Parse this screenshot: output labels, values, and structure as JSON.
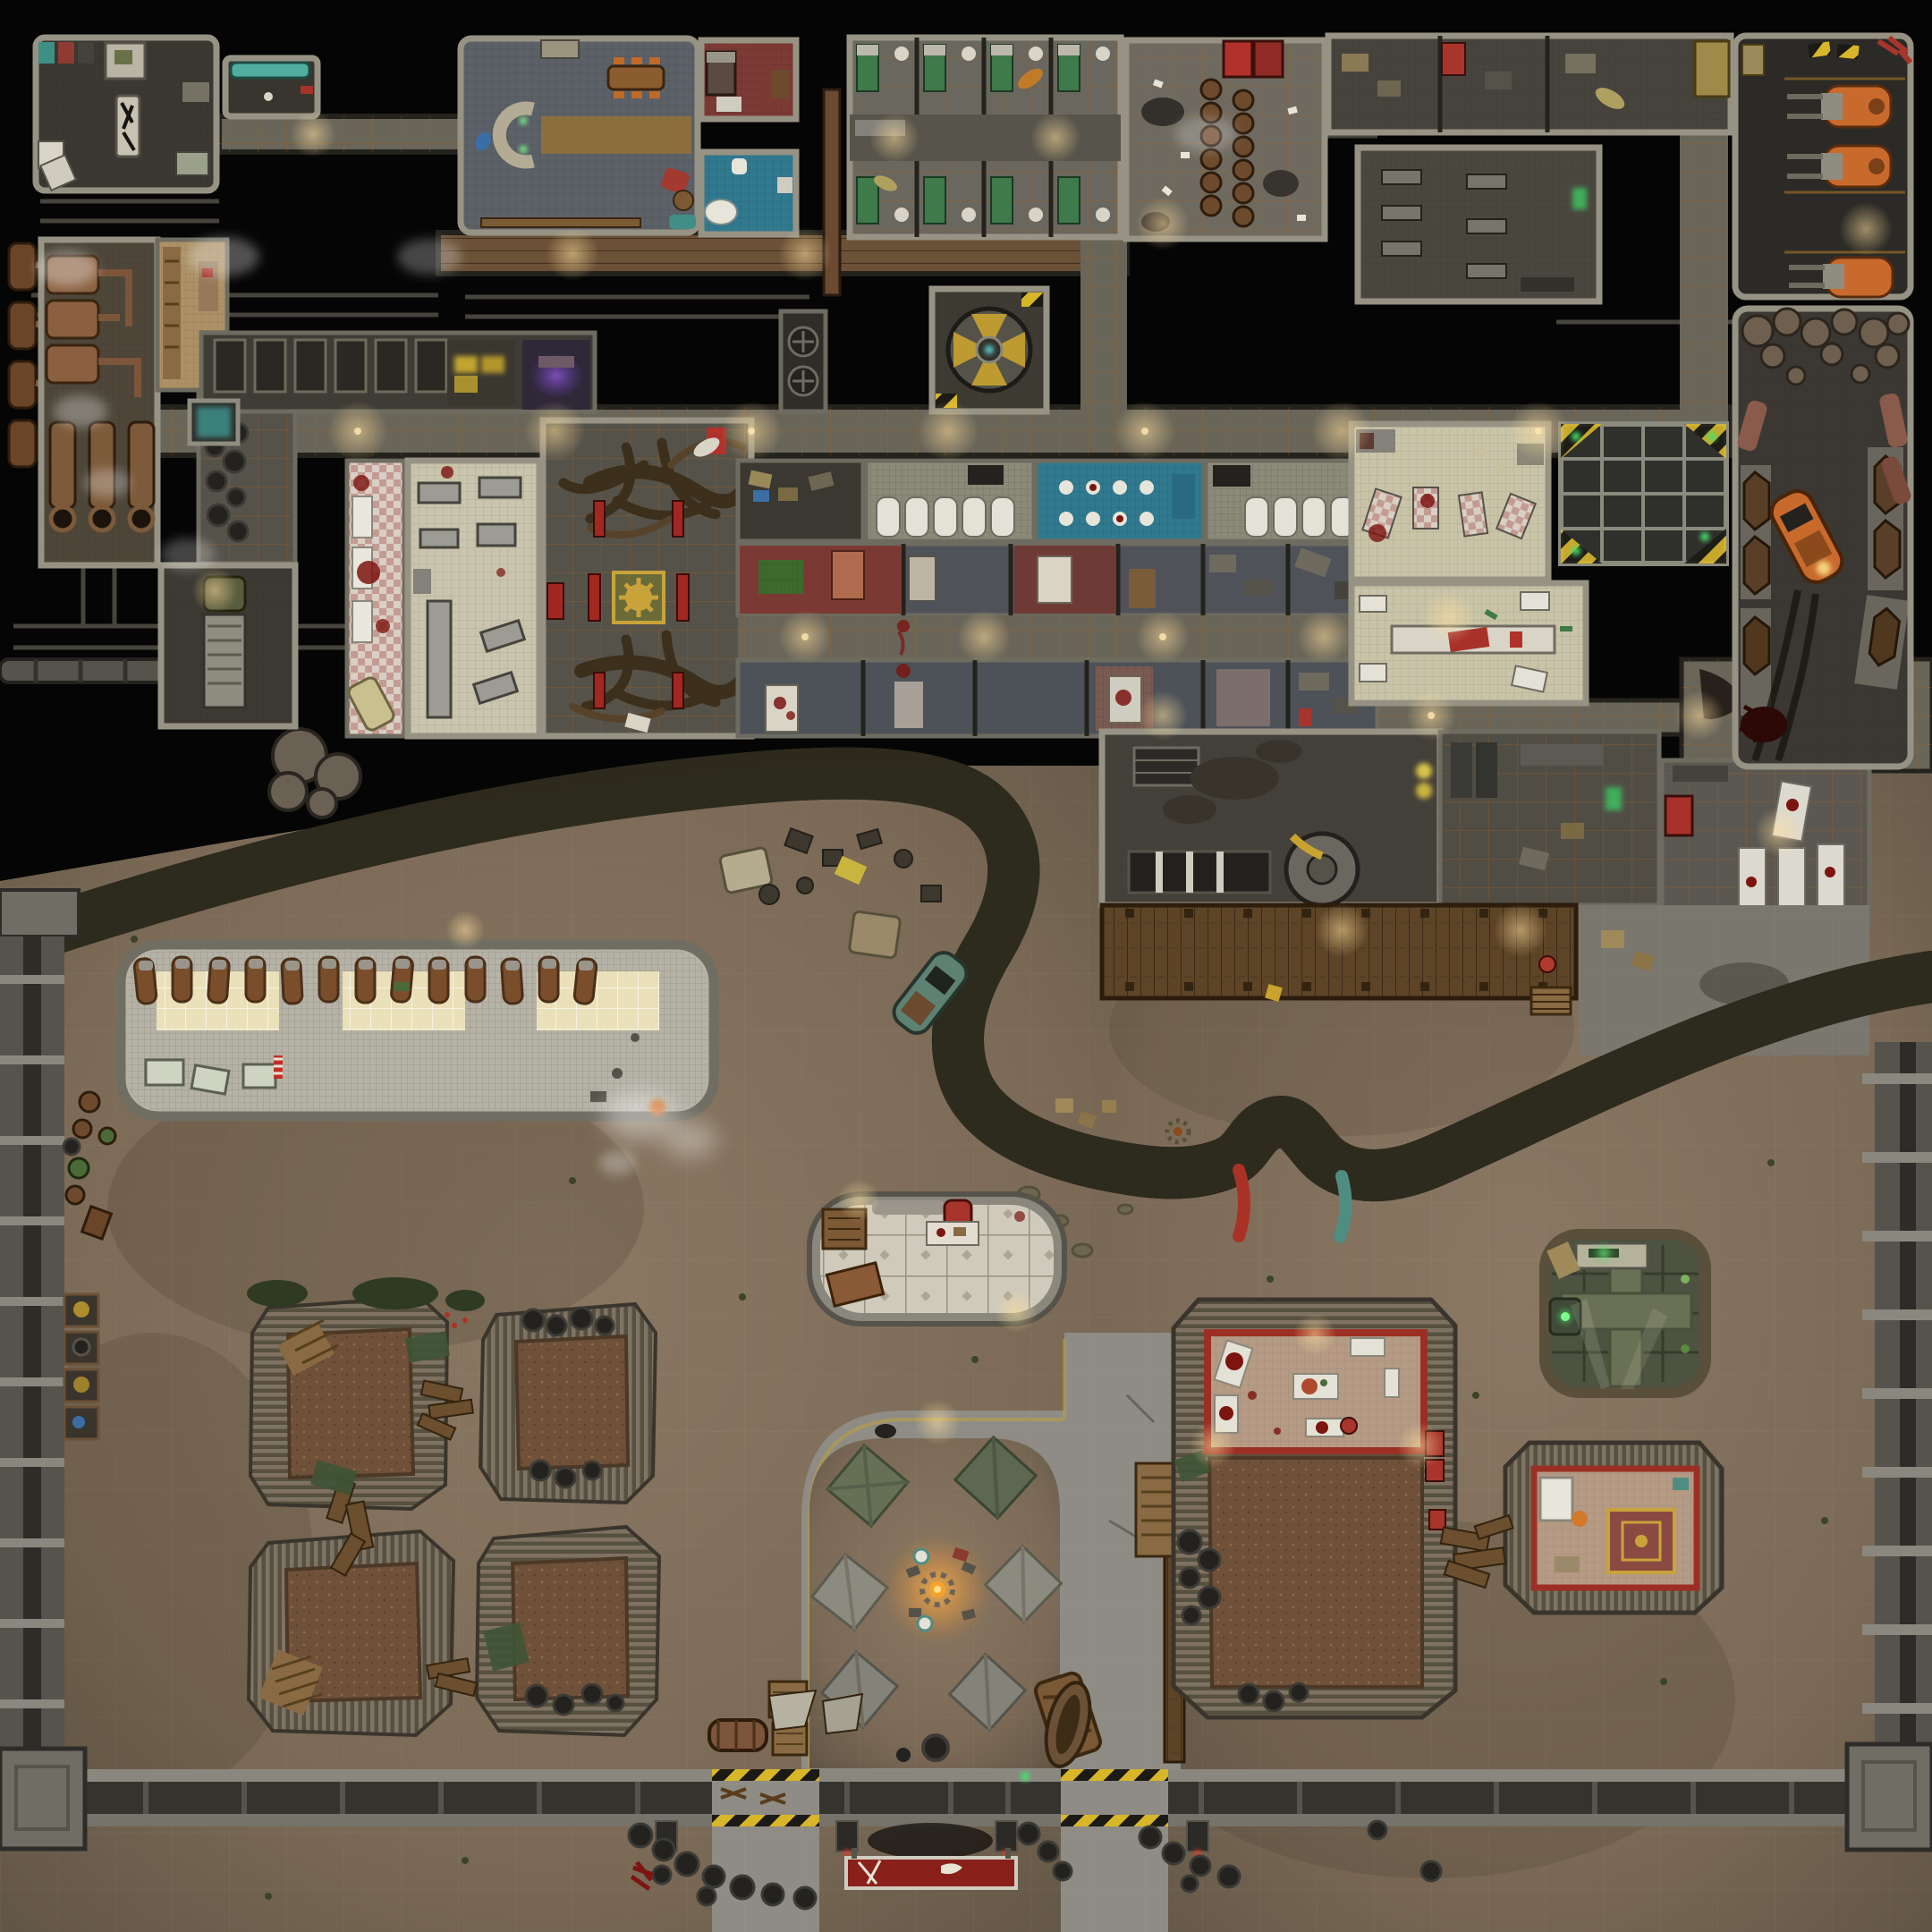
{
  "map": {
    "description": "Top-down post-apocalyptic battle map: underground vault facility to the north, wasteland shanty settlement to the south, divided by a giant winding root and walled perimeter",
    "grid_size_px": 64,
    "palette": {
      "void": "#050505",
      "wall": "#979384",
      "wall-dark": "#1d1c18",
      "floor-gray": "#5a574e",
      "floor-dark": "#3a3830",
      "tile-mid": "#696559",
      "corridor-rust": "#6b5136",
      "office-blue": "#5c6168",
      "carpet-tan": "#8d6f3e",
      "red-room": "#7c3a35",
      "bath-blue": "#30798e",
      "cream": "#c9c4a8",
      "bed-green": "#3e7a4a",
      "barrel-brown": "#6e4a2c",
      "vehicle-orange": "#c96a2d",
      "copper": "#7c553a",
      "altar-gold": "#c9a33a",
      "altar-green": "#6b6b3a",
      "pew-red": "#a02820",
      "root-dark": "#3a3527",
      "root-mid": "#7b7257",
      "root-fiber": "#5e573f",
      "dirt": "#82705c",
      "dirt-dark": "#625849",
      "asphalt": "#8e8c85",
      "mesh-roof": "#b5b2a6",
      "light-panel": "#efe4bb",
      "bedroll": "#7a4e2b",
      "corr-a": "#7d7466",
      "corr-b": "#57503f",
      "shanty-roof": "#6f5039",
      "tile-cream": "#cfcabb",
      "trim-red": "#9c2f24",
      "bunker-green": "#4d5340",
      "metal-wall": "#6f6d64",
      "hazard-yellow": "#d8b62a",
      "fire-orange": "#f4a22e",
      "glow-warm": "#ffd98a",
      "tent-green": "#7b7d6c",
      "blood": "#7c1410",
      "teal": "#4f8d82"
    },
    "facility": {
      "rooms": [
        "armory",
        "lounge-nook",
        "overseer-office",
        "red-bedroom",
        "blue-bathroom",
        "cell-block",
        "canteen-barrel-hall",
        "storage-rooms",
        "workshop",
        "forklift-garage",
        "boiler-room",
        "pump-room",
        "supply-room",
        "tire-store",
        "truck-bay",
        "detention-row",
        "server-glow-room",
        "purple-shrine-nook",
        "display-case",
        "root-shrine-hall",
        "kitchen",
        "checker-tile-morgue",
        "shower-room-west",
        "blue-toilet-room",
        "shower-room-east",
        "bedroom-row-upper",
        "bedroom-row-lower",
        "cafeteria",
        "serving-hall",
        "skylight-grate",
        "dark-warehouse",
        "store-rooms",
        "white-slab-morgue",
        "coffin-crypt",
        "machine-fan-room"
      ],
      "counts": {
        "forklifts": 3,
        "prison_cells": 8,
        "boilers": 3,
        "pumps": 3,
        "coffins": 7,
        "shower_stalls": 10,
        "canteen_barrels": 12
      }
    },
    "settlement": {
      "structures": [
        "dormitory-hall",
        "tiled-lounge-trailer",
        "shanty-hut-nw",
        "shanty-hut-ne",
        "shanty-hut-sw",
        "shanty-hut-se",
        "butcher-building",
        "annex-building",
        "green-bunker",
        "wood-deck",
        "boardwalk",
        "west-perimeter-wall",
        "east-perimeter-wall",
        "south-perimeter-wall",
        "gate-west",
        "gate-east"
      ],
      "counts": {
        "bedrolls": 13,
        "tents": 6,
        "gate_turrets": 4,
        "skylight_panels": 3,
        "wall_workbench_stalls": 4
      }
    },
    "features": [
      "giant-winding-root",
      "root-tip-red",
      "root-tip-teal",
      "campfire",
      "nuka-billboard",
      "tire-heaps",
      "wrecked-teal-car",
      "orange-wasteland-car",
      "junk-field",
      "steam-vents",
      "blood-pools",
      "tire-tracks"
    ]
  }
}
